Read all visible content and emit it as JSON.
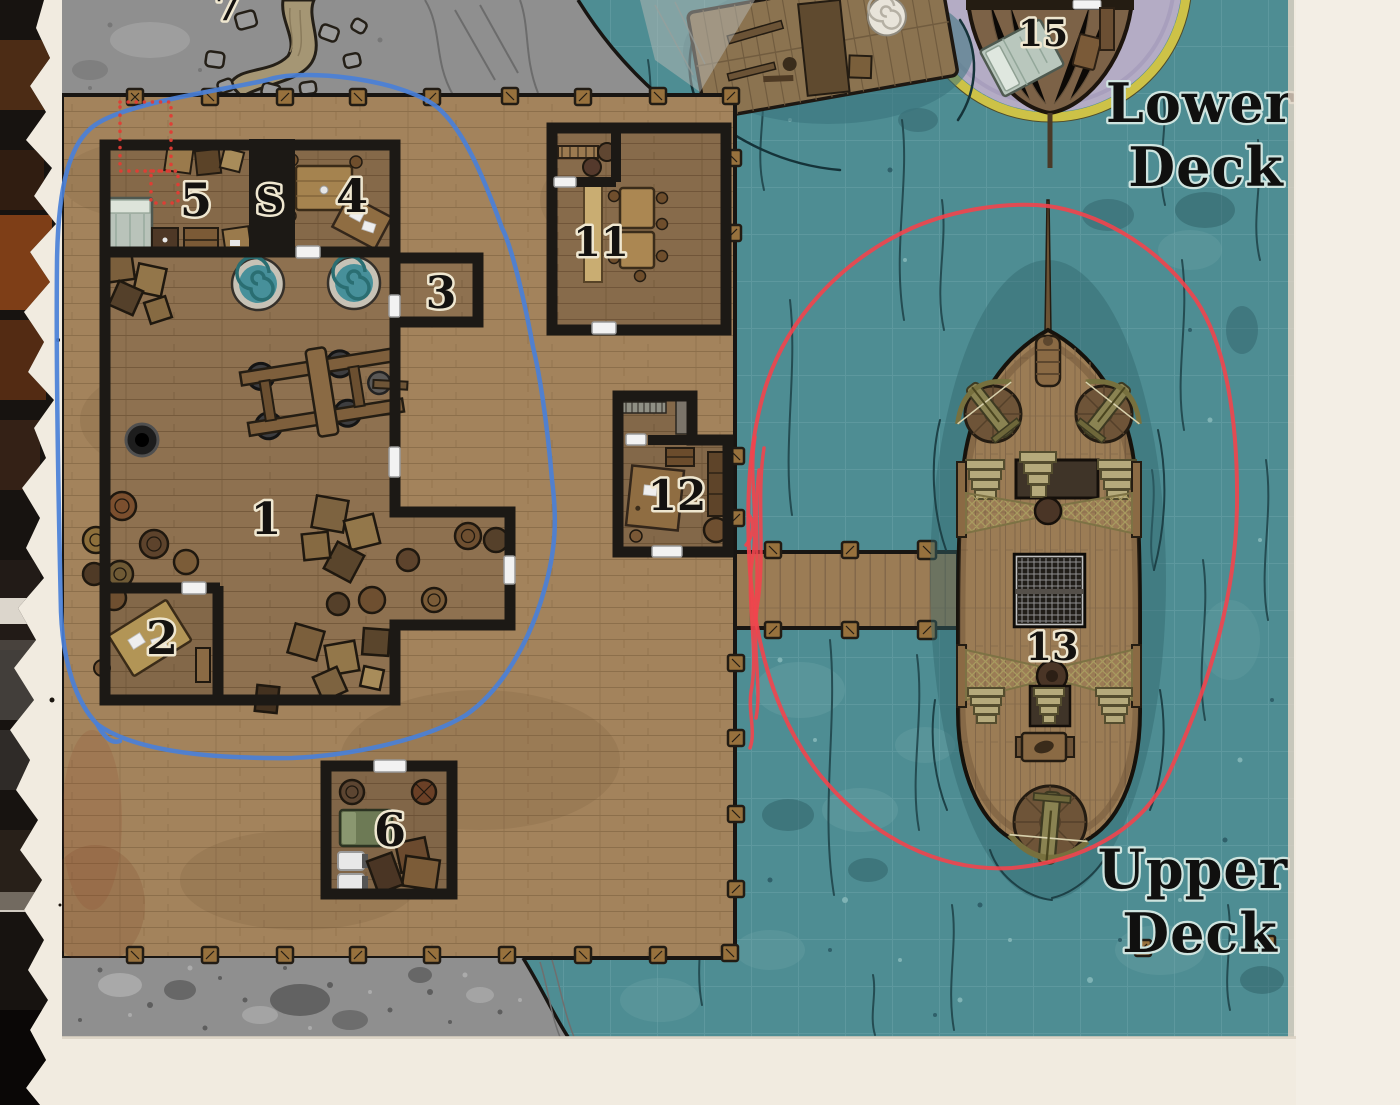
{
  "labels": {
    "r1": "1",
    "r2": "2",
    "r3": "3",
    "r4": "4",
    "r5": "5",
    "r6": "6",
    "r7": "7",
    "stairs": "S",
    "r11": "11",
    "r12": "12",
    "r13": "13",
    "r15": "15"
  },
  "deck_labels": {
    "lower_line1": "Lower",
    "lower_line2": "Deck",
    "upper_line1": "Upper",
    "upper_line2": "Deck"
  },
  "colors": {
    "water": "#4e8d93",
    "dock_wood": "#a3835c",
    "interior_wood": "#8e7150",
    "stone": "#8f8f8f",
    "wall_black": "#1c1915",
    "paper": "#f1ebe0",
    "annotation_blue": "#4a80d8",
    "annotation_red": "#f2444d",
    "trap_marker_red": "#e23c34",
    "ship_ring_purple": "#b4acc5",
    "ship_ring_gold": "#cdc247"
  }
}
